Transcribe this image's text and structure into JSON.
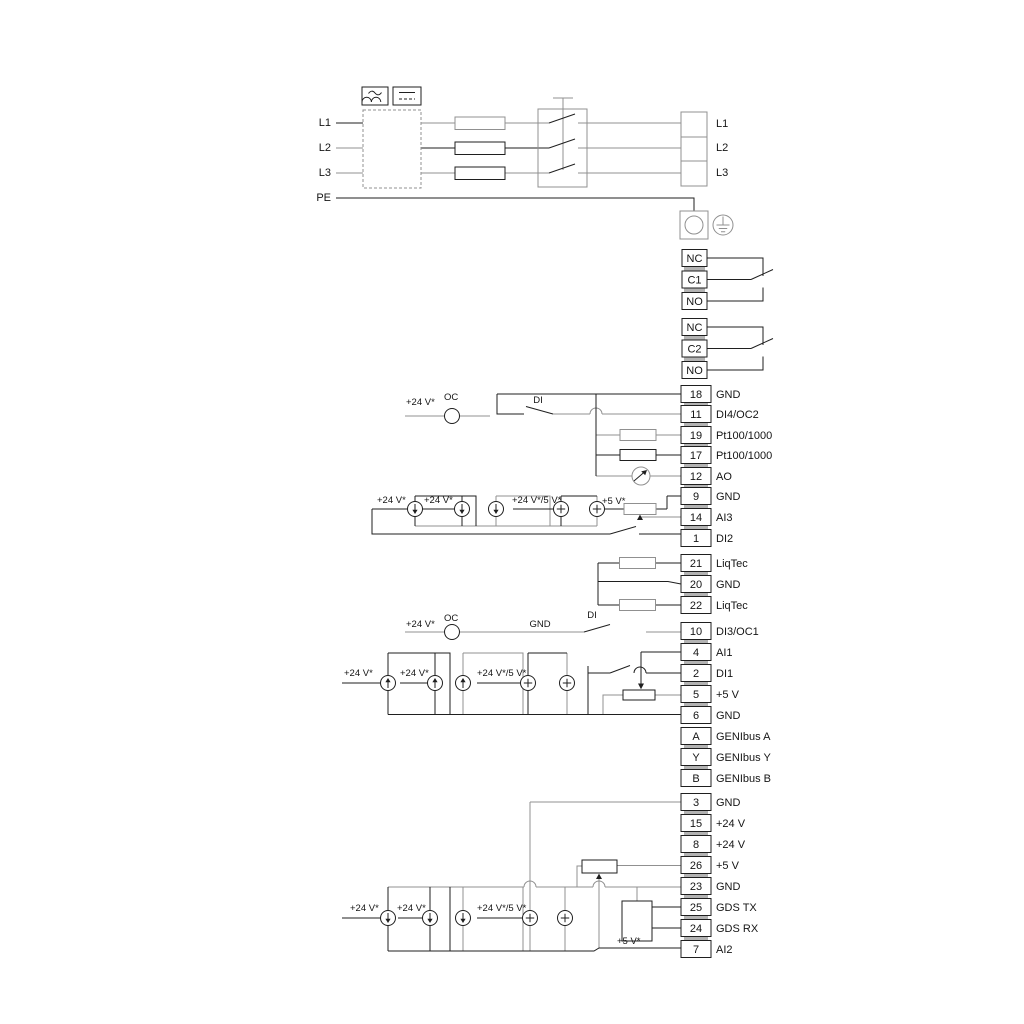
{
  "figure": {
    "type": "wiring-diagram",
    "bg": "#ffffff",
    "line_black": "#1f1f1f",
    "line_grey": "#909090"
  },
  "power": {
    "inputs": [
      "L1",
      "L2",
      "L3",
      "PE"
    ],
    "block": [
      "L1",
      "L2",
      "L3"
    ]
  },
  "relays": [
    {
      "cells": [
        "NC",
        "C1",
        "NO"
      ]
    },
    {
      "cells": [
        "NC",
        "C2",
        "NO"
      ]
    }
  ],
  "terminals": [
    {
      "n": "18",
      "label": "GND"
    },
    {
      "n": "11",
      "label": "DI4/OC2"
    },
    {
      "n": "19",
      "label": "Pt100/1000"
    },
    {
      "n": "17",
      "label": "Pt100/1000"
    },
    {
      "n": "12",
      "label": "AO"
    },
    {
      "n": "9",
      "label": "GND"
    },
    {
      "n": "14",
      "label": "AI3"
    },
    {
      "n": "1",
      "label": "DI2"
    },
    {
      "n": "21",
      "label": "LiqTec"
    },
    {
      "n": "20",
      "label": "GND"
    },
    {
      "n": "22",
      "label": "LiqTec"
    },
    {
      "n": "10",
      "label": "DI3/OC1"
    },
    {
      "n": "4",
      "label": "AI1"
    },
    {
      "n": "2",
      "label": "DI1"
    },
    {
      "n": "5",
      "label": "+5 V"
    },
    {
      "n": "6",
      "label": "GND"
    },
    {
      "n": "A",
      "label": "GENIbus A"
    },
    {
      "n": "Y",
      "label": "GENIbus Y"
    },
    {
      "n": "B",
      "label": "GENIbus B"
    },
    {
      "n": "3",
      "label": "GND"
    },
    {
      "n": "15",
      "label": "+24 V"
    },
    {
      "n": "8",
      "label": "+24 V"
    },
    {
      "n": "26",
      "label": "+5 V"
    },
    {
      "n": "23",
      "label": "GND"
    },
    {
      "n": "25",
      "label": "GDS TX"
    },
    {
      "n": "24",
      "label": "GDS RX"
    },
    {
      "n": "7",
      "label": "AI2"
    }
  ],
  "ann": {
    "v24": "+24 V*",
    "v24v5": "+24 V*/5 V*",
    "v5": "+5 V*",
    "oc": "OC",
    "di": "DI",
    "gnd": "GND"
  }
}
